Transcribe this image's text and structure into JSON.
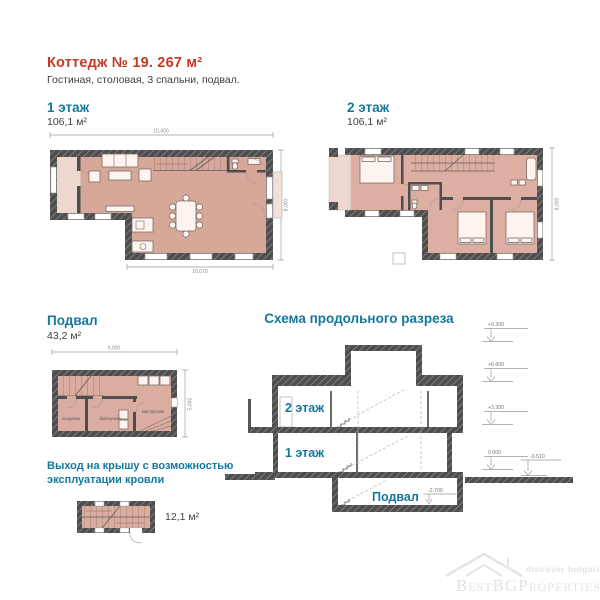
{
  "colors": {
    "accent_red": "#c13a27",
    "heading_teal": "#14789e",
    "plan_fill": "#d7a79a",
    "plan_fill_light": "#eed7ce",
    "wall_gray": "#4e4e4e",
    "dim_gray": "#8b8b8b",
    "watermark_gray": "#e2e2e2"
  },
  "header": {
    "title": "Коттедж № 19. 267 м²",
    "subtitle": "Гостиная, столовая, 3 спальни, подвал."
  },
  "floor1": {
    "heading": "1 этаж",
    "area": "106,1 м²",
    "dim_top": "15,400",
    "dim_bottom": "10,070",
    "dim_right": "8,000"
  },
  "floor2": {
    "heading": "2 этаж",
    "area": "106,1 м²",
    "dim_right": "8,000"
  },
  "basement": {
    "heading": "Подвал",
    "area": "43,2 м²",
    "dim_top": "9,000",
    "dim_right": "5,000",
    "rooms": {
      "storage": "кладовка",
      "boiler": "бойлерная",
      "workshop": "мастерская"
    }
  },
  "section": {
    "title": "Схема продольного разреза",
    "floor2_label": "2 этаж",
    "floor1_label": "1 этаж",
    "basement_label": "Подвал",
    "elev_ridge": "+9.200",
    "elev_attic": "+6.600",
    "elev_floor2": "+3.300",
    "elev_zero": "0.000",
    "elev_terrain": "-0.510",
    "elev_basement": "-2.700"
  },
  "roof_access": {
    "note_line1": "Выход на крышу с возможностью",
    "note_line2": "эксплуатации кровли",
    "area": "12,1 м²"
  },
  "watermark": {
    "tagline": "discover bulgaria",
    "brand": "BestBGProperties"
  }
}
